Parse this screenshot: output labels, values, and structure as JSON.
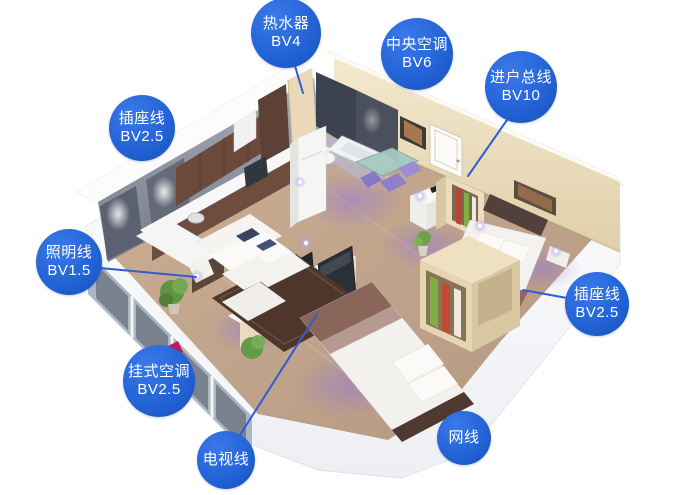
{
  "figure": {
    "type": "home-wiring-isometric-floorplan",
    "background": "#ffffff"
  },
  "colors": {
    "label_blue": "#2161d4",
    "label_blue_light": "#3a79e8",
    "label_blue_dark": "#1950b4",
    "leader_blue": "#2f5cd6",
    "wall_cream": "#ecdfc0",
    "wall_gray": "#8a909c",
    "floor_wood": "#c2a78a",
    "rug_brown": "#4e372a",
    "glow_purple": "#9274d8"
  },
  "callouts": [
    {
      "id": "water-heater",
      "lines": [
        "热水器",
        "BV4"
      ],
      "cx": 286,
      "cy": 33,
      "r": 35,
      "leader": {
        "x1": 295,
        "y1": 66,
        "x2": 303,
        "y2": 93
      }
    },
    {
      "id": "central-ac",
      "lines": [
        "中央空调",
        "BV6"
      ],
      "cx": 417,
      "cy": 54,
      "r": 36,
      "leader": null
    },
    {
      "id": "incoming-main",
      "lines": [
        "进户总线",
        "BV10"
      ],
      "cx": 521,
      "cy": 87,
      "r": 36,
      "leader": {
        "x1": 507,
        "y1": 120,
        "x2": 468,
        "y2": 176
      }
    },
    {
      "id": "socket-line-left",
      "lines": [
        "插座线",
        "BV2.5"
      ],
      "cx": 142,
      "cy": 128,
      "r": 33,
      "leader": null
    },
    {
      "id": "lighting-line",
      "lines": [
        "照明线",
        "BV1.5"
      ],
      "cx": 69,
      "cy": 262,
      "r": 33,
      "leader": {
        "x1": 100,
        "y1": 268,
        "x2": 196,
        "y2": 277
      }
    },
    {
      "id": "wall-ac",
      "lines": [
        "挂式空调",
        "BV2.5"
      ],
      "cx": 159,
      "cy": 381,
      "r": 36,
      "leader": null
    },
    {
      "id": "tv-line",
      "lines": [
        "电视线"
      ],
      "cx": 226,
      "cy": 460,
      "r": 29,
      "leader": {
        "x1": 240,
        "y1": 435,
        "x2": 317,
        "y2": 314
      }
    },
    {
      "id": "network-line",
      "lines": [
        "网线"
      ],
      "cx": 464,
      "cy": 438,
      "r": 27,
      "leader": null
    },
    {
      "id": "socket-line-right",
      "lines": [
        "插座线",
        "BV2.5"
      ],
      "cx": 597,
      "cy": 304,
      "r": 32,
      "leader": {
        "x1": 567,
        "y1": 298,
        "x2": 523,
        "y2": 290
      }
    }
  ]
}
